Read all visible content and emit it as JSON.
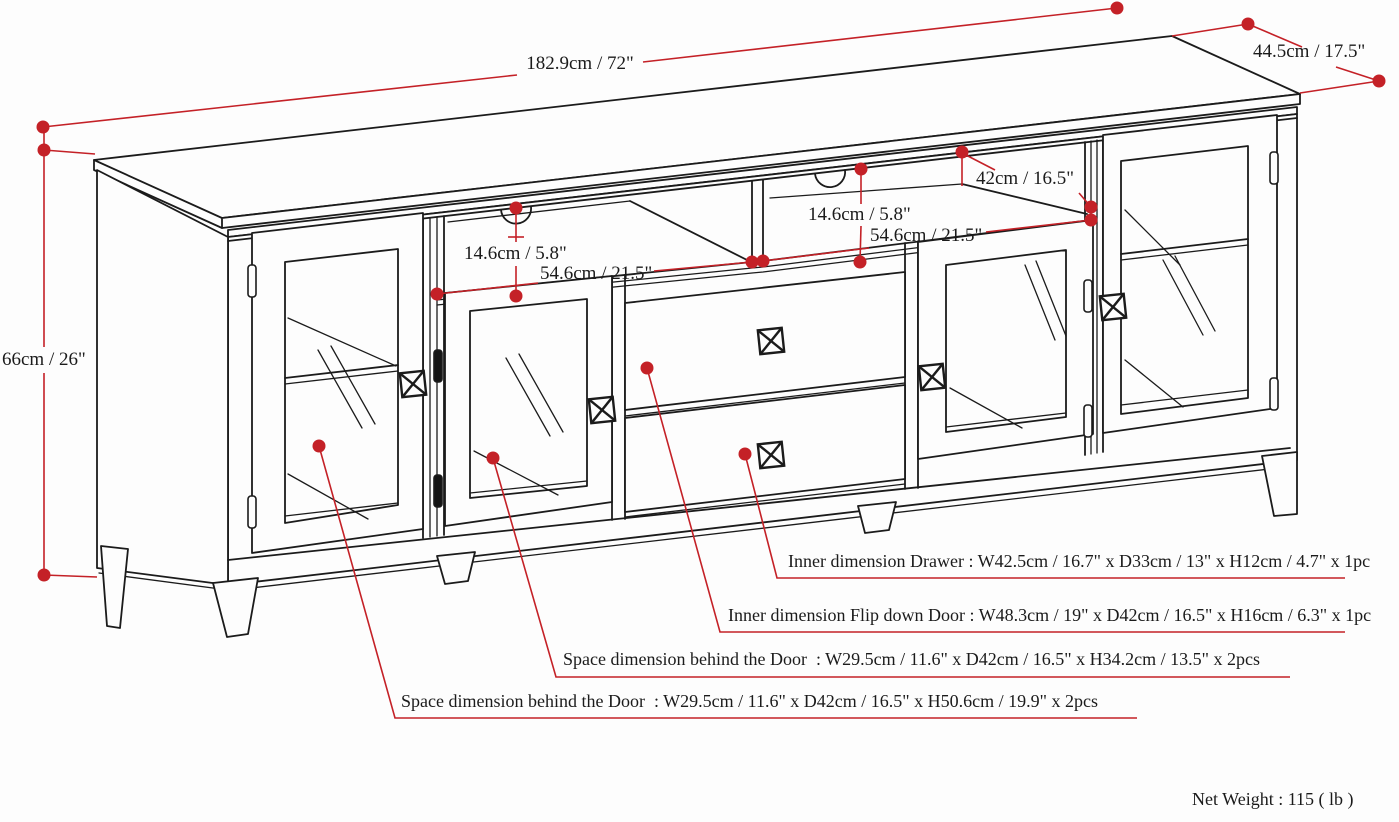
{
  "title": "TV stand dimension diagram",
  "colors": {
    "red": "#c42127",
    "ink": "#1b1b1b"
  },
  "labels": {
    "dim_width_total": "182.9cm / 72\"",
    "dim_depth_total": "44.5cm / 17.5\"",
    "dim_height_total": "66cm / 26\"",
    "dim_shelf_height_left": "14.6cm / 5.8\"",
    "dim_shelf_height_right": "14.6cm / 5.8\"",
    "dim_shelf_width_left": "54.6cm / 21.5\"",
    "dim_shelf_width_right": "54.6cm / 21.5\"",
    "dim_shelf_depth": "42cm / 16.5\"",
    "callout_drawer": "Inner dimension Drawer : W42.5cm / 16.7\" x D33cm / 13\" x H12cm / 4.7\" x 1pc",
    "callout_flip_door": "Inner dimension Flip down Door : W48.3cm / 19\" x D42cm / 16.5\" x H16cm / 6.3\" x 1pc",
    "callout_space_upper": "Space dimension behind the Door  : W29.5cm / 11.6\" x D42cm / 16.5\" x H34.2cm / 13.5\" x 2pcs",
    "callout_space_lower": "Space dimension behind the Door  : W29.5cm / 11.6\" x D42cm / 16.5\" x H50.6cm / 19.9\" x 2pcs",
    "net_weight": "Net Weight : 115 ( lb )"
  }
}
